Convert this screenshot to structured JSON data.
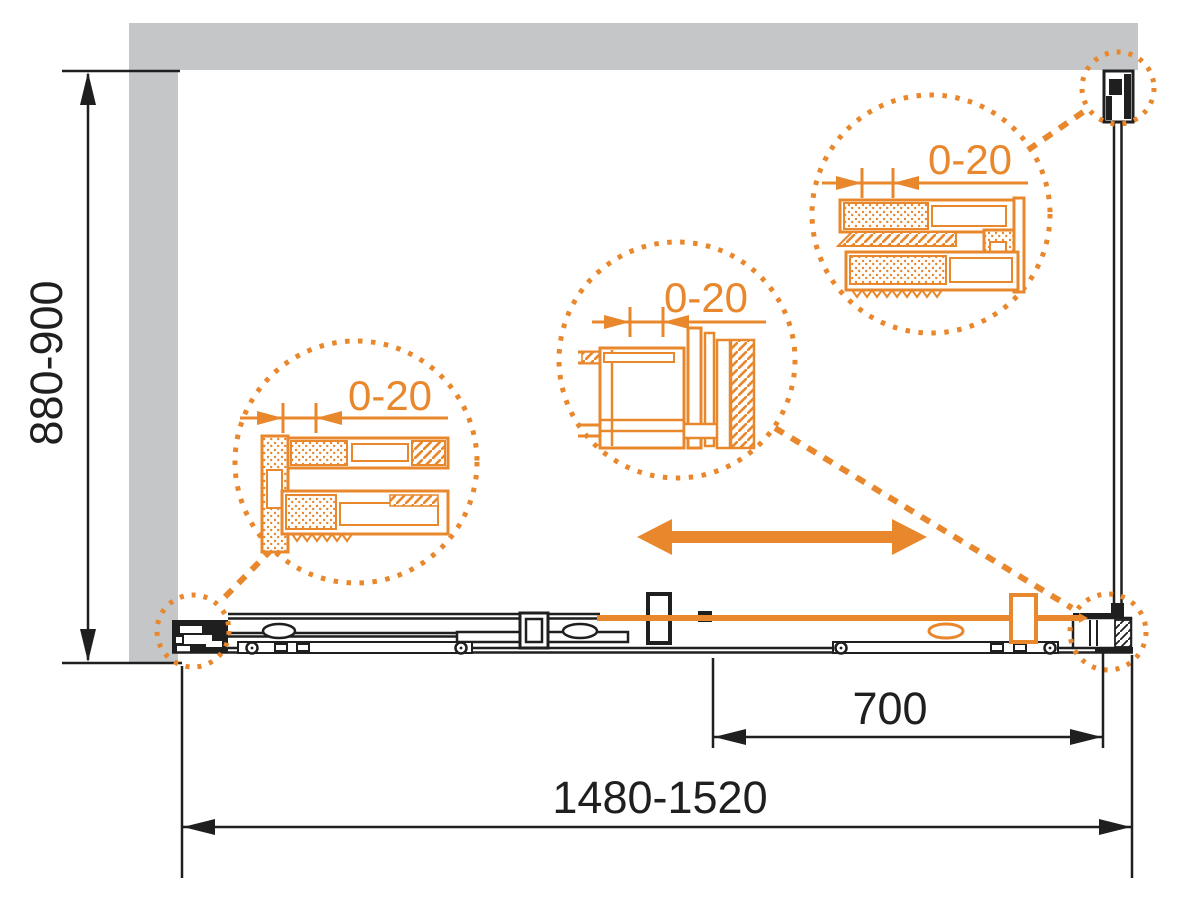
{
  "colors": {
    "accent_orange": "#E8872C",
    "wall_gray": "#C5C6C8",
    "line_black": "#1F1F1F"
  },
  "dimensions": {
    "height_label": "880-900",
    "overall_width_label": "1480-1520",
    "door_travel_label": "700"
  },
  "callouts": {
    "left": {
      "label": "0-20"
    },
    "middle": {
      "label": "0-20"
    },
    "top_right": {
      "label": "0-20"
    }
  }
}
